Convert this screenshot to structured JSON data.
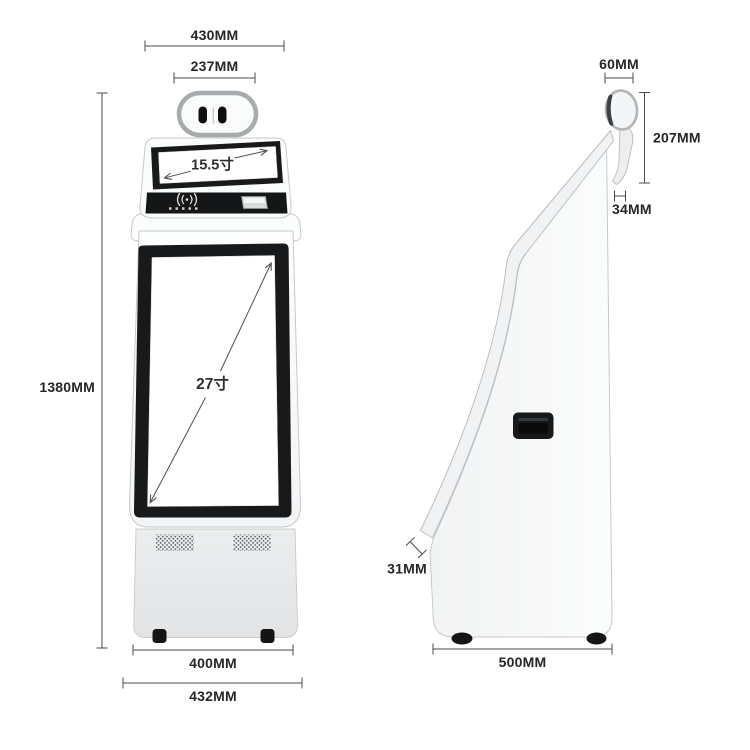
{
  "diagram": {
    "front": {
      "top_width": "430MM",
      "head_width": "237MM",
      "upper_screen": "15.5寸",
      "main_screen": "27寸",
      "height": "1380MM",
      "base_width": "400MM",
      "overall_width": "432MM"
    },
    "side": {
      "head_depth": "60MM",
      "head_height": "207MM",
      "bracket": "34MM",
      "screen_thickness": "31MM",
      "depth": "500MM"
    },
    "colors": {
      "background": "#ffffff",
      "bezel": "#17191b",
      "dim_line": "#4a4a4a",
      "text": "#262626"
    }
  }
}
